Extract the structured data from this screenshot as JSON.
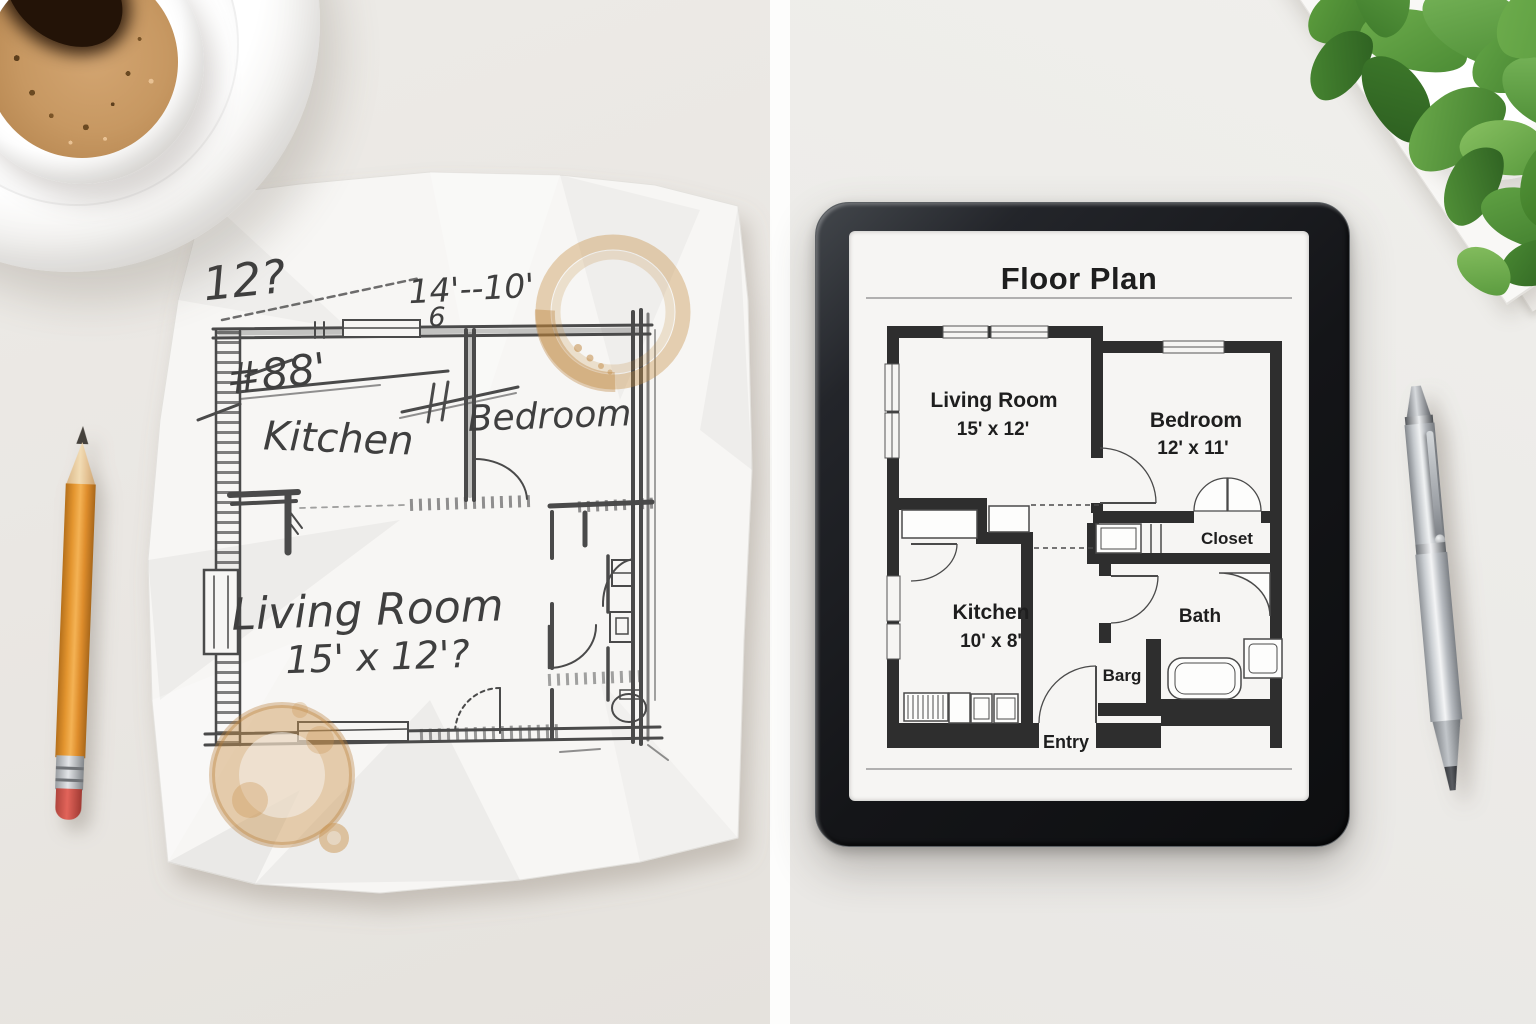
{
  "left_panel": {
    "sketch_labels": {
      "dim_question": "12?",
      "width_dim": "14'--10'",
      "width_sub": "6",
      "height_dim": "#88'",
      "kitchen": "Kitchen",
      "bedroom": "Bedroom",
      "living_room": "Living Room",
      "living_dim": "15' x 12'?"
    },
    "objects": [
      "coffee-cup",
      "saucer",
      "pencil",
      "crumpled-paper-sketch",
      "coffee-stains"
    ]
  },
  "right_panel": {
    "tablet": {
      "title": "Floor Plan",
      "rooms": [
        {
          "name": "Living Room",
          "dim": "15' x 12'"
        },
        {
          "name": "Bedroom",
          "dim": "12' x 11'"
        },
        {
          "name": "Kitchen",
          "dim": "10' x 8'"
        },
        {
          "name": "Closet",
          "dim": ""
        },
        {
          "name": "Bath",
          "dim": ""
        },
        {
          "name": "Barg",
          "dim": ""
        },
        {
          "name": "Entry",
          "dim": ""
        }
      ]
    },
    "objects": [
      "tablet",
      "silver-pen",
      "potted-plant",
      "paper-stack"
    ]
  },
  "colors": {
    "coffee_stain": "#c08b4e",
    "coffee_crema": "#c79862",
    "pencil_body": "#e09135",
    "pencil_eraser": "#cc5148",
    "tablet_frame": "#17181b",
    "plan_wall": "#2e2e2e",
    "plant_green": "#56973b",
    "desk": "#eae7e3"
  }
}
